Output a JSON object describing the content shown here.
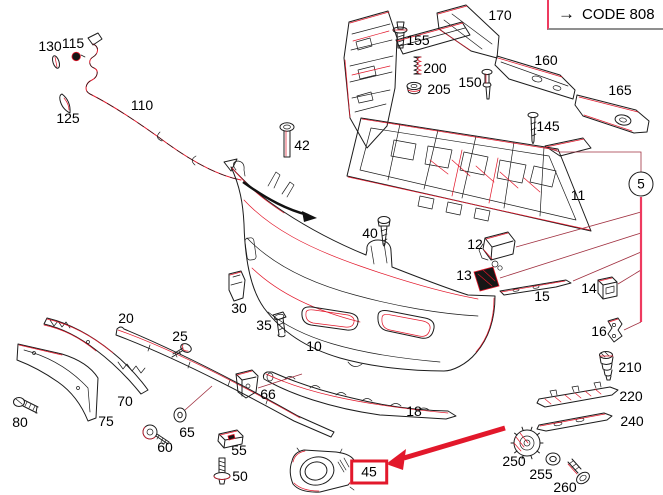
{
  "diagram_type": "exploded-parts-diagram",
  "legend": {
    "arrow": "→",
    "code": "CODE 808"
  },
  "callout": {
    "number": "5"
  },
  "highlight": {
    "boxed_part": "45"
  },
  "colors": {
    "accent_red": "#e2182b",
    "leader_pink": "#ee3a5f",
    "line_black": "#1c1c1c"
  },
  "parts": [
    {
      "id": "130",
      "x": 50,
      "y": 46
    },
    {
      "id": "115",
      "x": 73,
      "y": 43
    },
    {
      "id": "125",
      "x": 68,
      "y": 118
    },
    {
      "id": "110",
      "x": 142,
      "y": 105
    },
    {
      "id": "42",
      "x": 302,
      "y": 145
    },
    {
      "id": "155",
      "x": 418,
      "y": 40
    },
    {
      "id": "200",
      "x": 435,
      "y": 68
    },
    {
      "id": "205",
      "x": 439,
      "y": 89
    },
    {
      "id": "150",
      "x": 470,
      "y": 82
    },
    {
      "id": "170",
      "x": 500,
      "y": 15
    },
    {
      "id": "160",
      "x": 546,
      "y": 60
    },
    {
      "id": "165",
      "x": 620,
      "y": 90
    },
    {
      "id": "145",
      "x": 548,
      "y": 126
    },
    {
      "id": "11",
      "x": 578,
      "y": 195
    },
    {
      "id": "40",
      "x": 370,
      "y": 233
    },
    {
      "id": "12",
      "x": 475,
      "y": 244
    },
    {
      "id": "13",
      "x": 464,
      "y": 275
    },
    {
      "id": "15",
      "x": 542,
      "y": 296
    },
    {
      "id": "14",
      "x": 589,
      "y": 288
    },
    {
      "id": "16",
      "x": 599,
      "y": 331
    },
    {
      "id": "210",
      "x": 630,
      "y": 367
    },
    {
      "id": "220",
      "x": 631,
      "y": 396
    },
    {
      "id": "240",
      "x": 632,
      "y": 421
    },
    {
      "id": "250",
      "x": 514,
      "y": 461
    },
    {
      "id": "255",
      "x": 541,
      "y": 474
    },
    {
      "id": "260",
      "x": 565,
      "y": 487
    },
    {
      "id": "10",
      "x": 314,
      "y": 346
    },
    {
      "id": "20",
      "x": 126,
      "y": 318
    },
    {
      "id": "25",
      "x": 180,
      "y": 336
    },
    {
      "id": "30",
      "x": 239,
      "y": 308
    },
    {
      "id": "35",
      "x": 264,
      "y": 325
    },
    {
      "id": "66",
      "x": 268,
      "y": 394
    },
    {
      "id": "70",
      "x": 125,
      "y": 401
    },
    {
      "id": "75",
      "x": 106,
      "y": 421
    },
    {
      "id": "80",
      "x": 20,
      "y": 422
    },
    {
      "id": "65",
      "x": 187,
      "y": 432
    },
    {
      "id": "60",
      "x": 165,
      "y": 447
    },
    {
      "id": "55",
      "x": 239,
      "y": 450
    },
    {
      "id": "50",
      "x": 240,
      "y": 476
    },
    {
      "id": "18",
      "x": 414,
      "y": 411
    },
    {
      "id": "45",
      "x": 369,
      "y": 472,
      "boxed": true
    }
  ]
}
